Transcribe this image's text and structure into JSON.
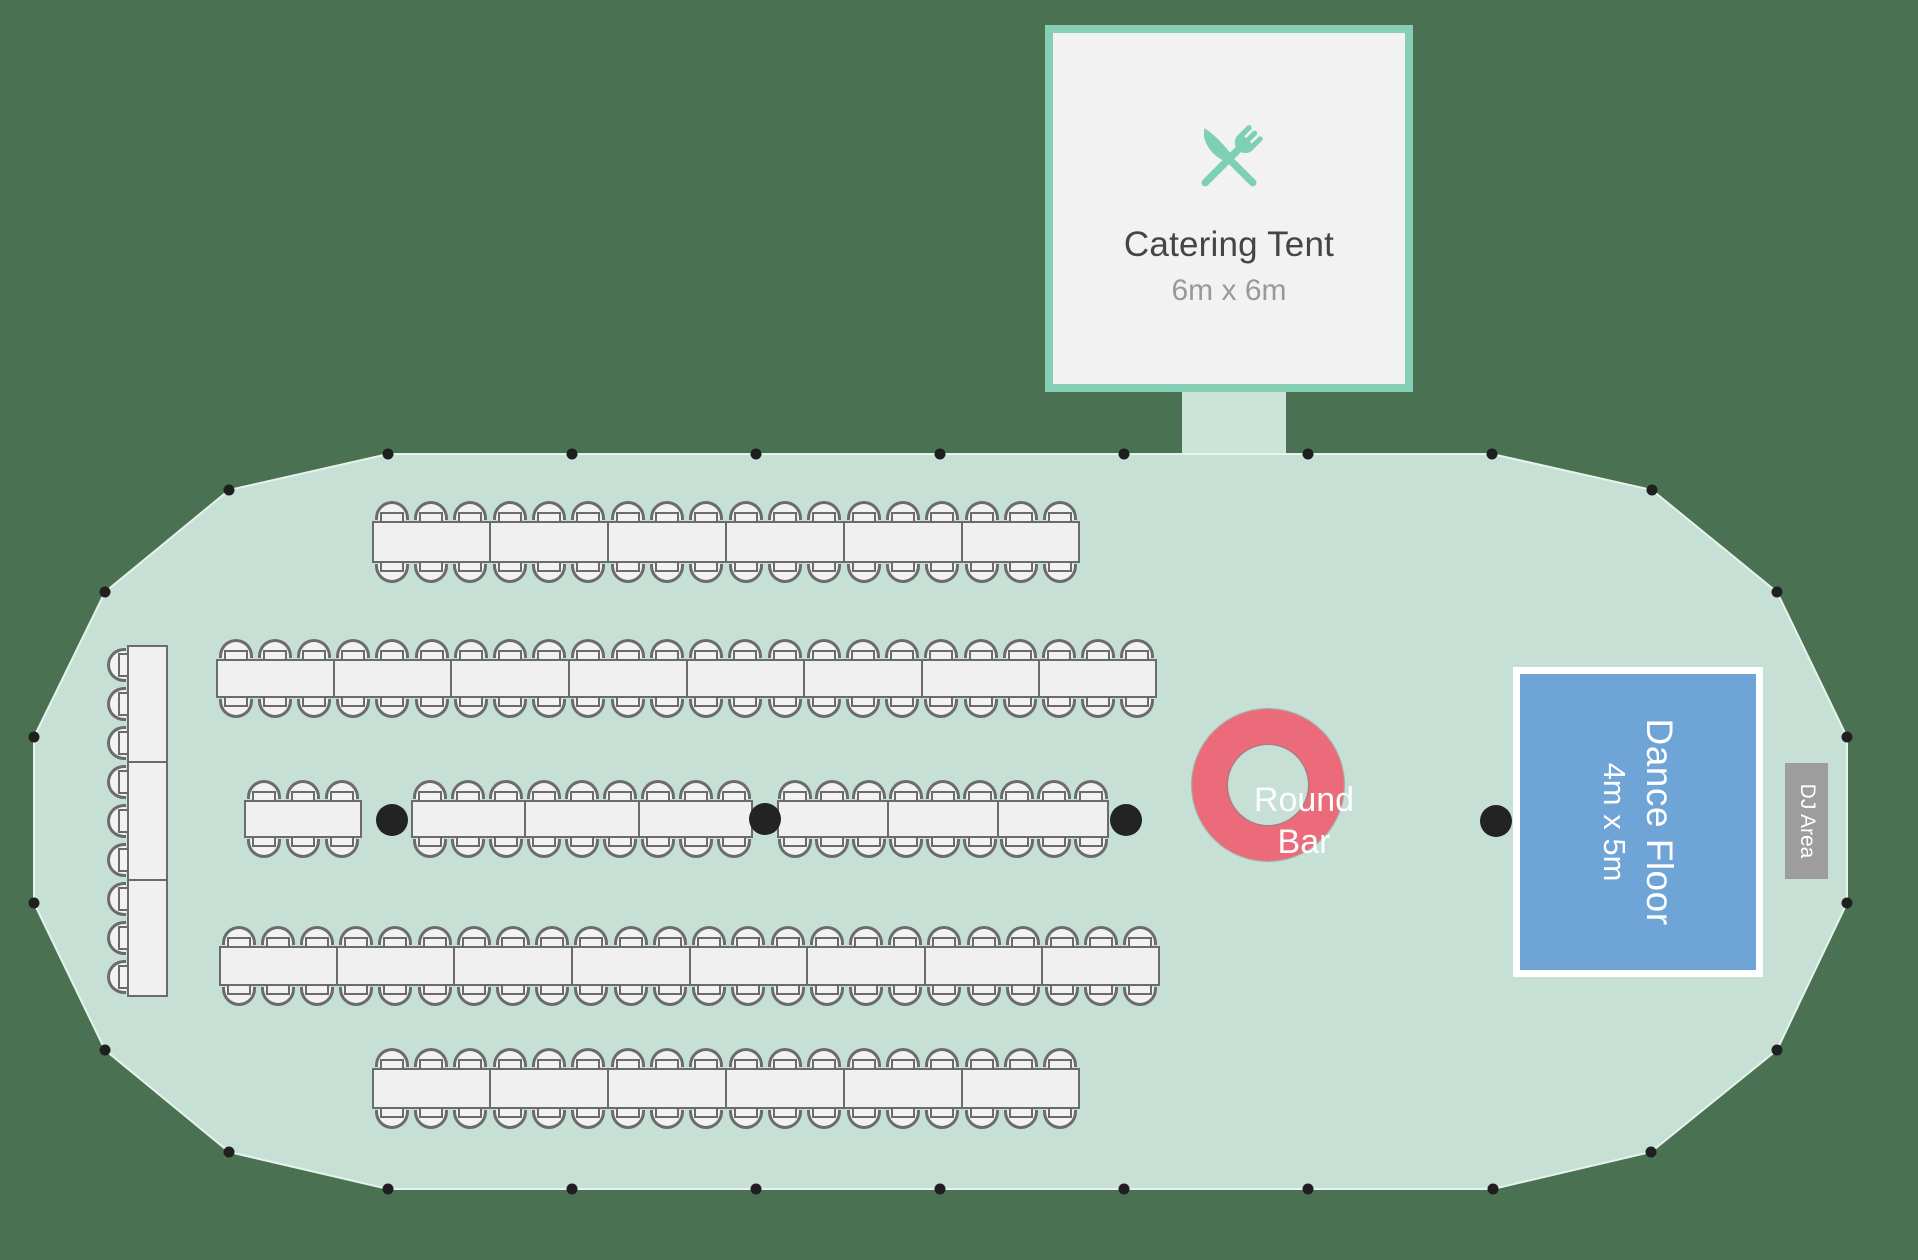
{
  "canvas": {
    "width": 1918,
    "height": 1260,
    "background": "#4a7252"
  },
  "tent": {
    "fill": "#c6e0d5",
    "edge_color": "#e7f2ec",
    "dot_color": "#1f1f1f",
    "dot_radius": 5.5,
    "polygon": [
      [
        388,
        454
      ],
      [
        1492,
        454
      ],
      [
        1652,
        490
      ],
      [
        1777,
        592
      ],
      [
        1847,
        737
      ],
      [
        1847,
        903
      ],
      [
        1777,
        1050
      ],
      [
        1651,
        1152
      ],
      [
        1493,
        1189
      ],
      [
        388,
        1189
      ],
      [
        229,
        1152
      ],
      [
        105,
        1050
      ],
      [
        34,
        903
      ],
      [
        34,
        737
      ],
      [
        105,
        592
      ],
      [
        229,
        490
      ]
    ],
    "perimeter_dots": [
      [
        388,
        454
      ],
      [
        572,
        454
      ],
      [
        756,
        454
      ],
      [
        940,
        454
      ],
      [
        1124,
        454
      ],
      [
        1308,
        454
      ],
      [
        1492,
        454
      ],
      [
        1652,
        490
      ],
      [
        1777,
        592
      ],
      [
        1847,
        737
      ],
      [
        1847,
        903
      ],
      [
        1777,
        1050
      ],
      [
        1651,
        1152
      ],
      [
        1493,
        1189
      ],
      [
        1308,
        1189
      ],
      [
        1124,
        1189
      ],
      [
        940,
        1189
      ],
      [
        756,
        1189
      ],
      [
        572,
        1189
      ],
      [
        388,
        1189
      ],
      [
        229,
        1152
      ],
      [
        105,
        1050
      ],
      [
        34,
        903
      ],
      [
        34,
        737
      ],
      [
        105,
        592
      ],
      [
        229,
        490
      ]
    ],
    "support_poles": [
      {
        "x": 392,
        "y": 820
      },
      {
        "x": 765,
        "y": 819
      },
      {
        "x": 1126,
        "y": 820
      },
      {
        "x": 1496,
        "y": 821
      }
    ],
    "support_pole_radius": 16,
    "support_pole_color": "#232323"
  },
  "catering_tent": {
    "label": "Catering Tent",
    "size_label": "6m x 6m",
    "x": 1045,
    "y": 25,
    "width": 368,
    "height": 367,
    "border_color": "#85cfb5",
    "fill": "#f2f2f2",
    "icon": "fork-knife-icon",
    "icon_color": "#7ed0b4",
    "label_color": "#454545",
    "size_color": "#999999",
    "connector": {
      "x": 1182,
      "y": 390,
      "width": 104,
      "height": 68,
      "color": "#cbe4d7"
    }
  },
  "tables": {
    "fill": "#f0f0f0",
    "stroke": "#6b6b6b",
    "chair_fill": "#f2f2f2",
    "chair_stroke": "#6b6b6b",
    "rows": [
      {
        "name": "table-row-1",
        "x": 372,
        "y": 521,
        "w": 708,
        "h": 42,
        "segments": 6,
        "chairs": "top-bottom"
      },
      {
        "name": "table-row-2",
        "x": 216,
        "y": 659,
        "w": 941,
        "h": 39,
        "segments": 8,
        "chairs": "top-bottom"
      },
      {
        "name": "table-row-3-small",
        "x": 244,
        "y": 800,
        "w": 118,
        "h": 38,
        "segments": 1,
        "chairs": "top-bottom"
      },
      {
        "name": "table-row-3-mid",
        "x": 411,
        "y": 800,
        "w": 342,
        "h": 38,
        "segments": 3,
        "chairs": "top-bottom"
      },
      {
        "name": "table-row-3-right",
        "x": 777,
        "y": 800,
        "w": 332,
        "h": 38,
        "segments": 3,
        "chairs": "top-bottom"
      },
      {
        "name": "table-row-4",
        "x": 219,
        "y": 946,
        "w": 941,
        "h": 40,
        "segments": 8,
        "chairs": "top-bottom"
      },
      {
        "name": "table-row-5",
        "x": 372,
        "y": 1068,
        "w": 708,
        "h": 41,
        "segments": 6,
        "chairs": "top-bottom"
      },
      {
        "name": "vertical-side-table",
        "x": 127,
        "y": 645,
        "w": 41,
        "h": 352,
        "segments": 3,
        "chairs": "left"
      }
    ]
  },
  "round_bar": {
    "label_line1": "Round",
    "label_line2": "Bar",
    "cx": 1304,
    "cy": 821,
    "outer_radius": 112,
    "ring_thickness": 36,
    "ring_color": "#ec6b7a",
    "text_color": "#fbfdfc"
  },
  "dance_floor": {
    "label": "Dance Floor",
    "size_label": "4m x 5m",
    "x": 1513,
    "y": 667,
    "width": 250,
    "height": 310,
    "frame_color": "#ffffff",
    "fill": "#6fa5d6",
    "text_color": "#ffffff"
  },
  "dj_area": {
    "label": "DJ Area",
    "x": 1785,
    "y": 763,
    "width": 43,
    "height": 116,
    "fill": "#9d9d9d",
    "text_color": "#ffffff"
  }
}
